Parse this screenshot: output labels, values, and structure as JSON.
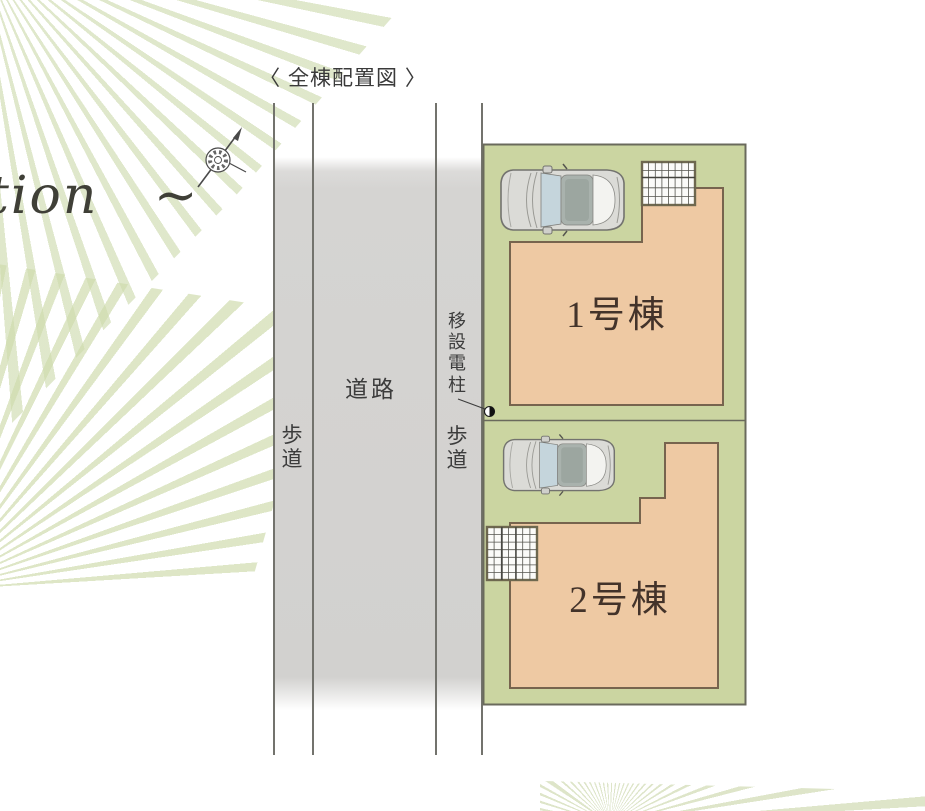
{
  "title": "〈 全棟配置図 〉",
  "watermark": {
    "text": "tion   ~"
  },
  "road": {
    "sidewalk_left": "歩道",
    "roadway": "道路",
    "sidewalk_right": "歩道",
    "pole_note": "移設電柱"
  },
  "site": {
    "building1_label": "1号棟",
    "building2_label": "2号棟"
  },
  "icons": {
    "compass": "north-arrow-compass",
    "pole": "half-filled-circle-utility-pole",
    "car": "top-view-car",
    "grid": "lattice-deck"
  },
  "colors": {
    "lot_green": "#cbd5a1",
    "building_orange": "#eec9a3",
    "road_gray": "#d5d4d2",
    "outline_dark": "#6a6a5c",
    "building_border": "#77644e",
    "label_brown": "#43332a",
    "text_dark": "#3c3c3c"
  }
}
